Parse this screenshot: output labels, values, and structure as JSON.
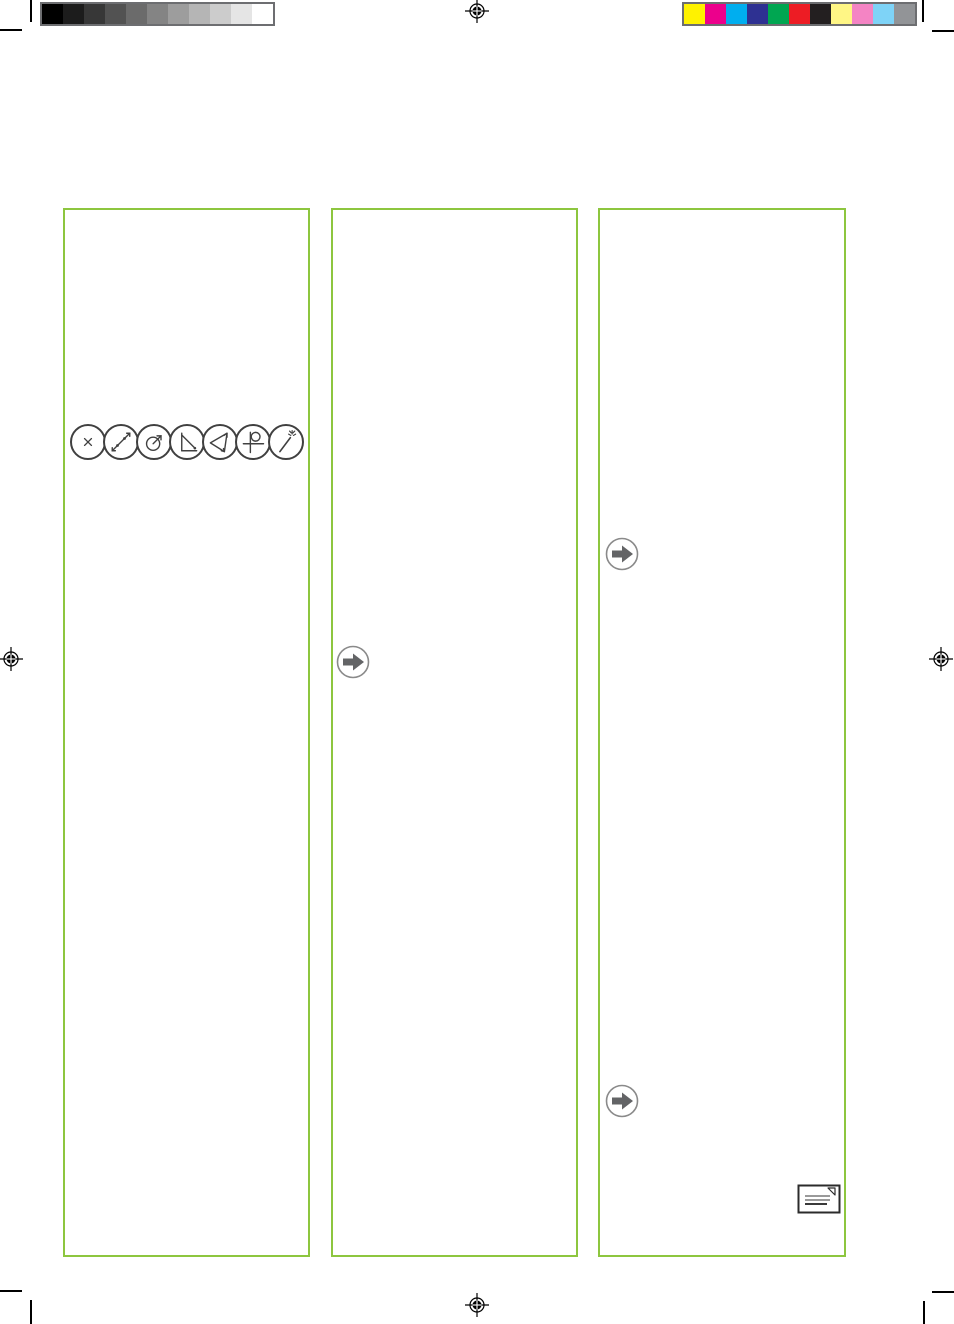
{
  "page": {
    "kind": "print-proof page, three empty text columns with printer marks",
    "background": "#FFFFFF",
    "accent_green": "#8DC63F",
    "mark_black": "#000000",
    "bar_border_gray": "#6D6E71"
  },
  "calibration": {
    "grayscale_bar": {
      "name": "grayscale-calibration-bar",
      "steps": [
        "#000000",
        "#1C1C1C",
        "#373737",
        "#525252",
        "#6B6B6B",
        "#848484",
        "#9D9D9D",
        "#B5B5B5",
        "#CCCCCC",
        "#E5E5E5",
        "#FFFFFF"
      ]
    },
    "color_bar": {
      "name": "cmyk-color-calibration-bar",
      "steps": [
        "#FFF200",
        "#EC008C",
        "#00AEEF",
        "#2E3192",
        "#00A651",
        "#ED1C24",
        "#231F20",
        "#FFF685",
        "#F484C4",
        "#7ED3F7",
        "#929497"
      ]
    }
  },
  "registration_marks": [
    {
      "position": "top-center"
    },
    {
      "position": "left-middle"
    },
    {
      "position": "right-middle"
    },
    {
      "position": "bottom-center"
    }
  ],
  "columns": [
    {
      "name": "column-1",
      "icons": [
        "point-cross-icon",
        "line-through-points-icon",
        "circle-arrow-icon",
        "right-angle-icon",
        "angle-triangle-icon",
        "perpendicular-loop-icon",
        "magic-wand-icon"
      ]
    },
    {
      "name": "column-2",
      "icons": [
        "arrow-right-icon"
      ]
    },
    {
      "name": "column-3",
      "icons": [
        "arrow-right-icon",
        "arrow-right-icon",
        "note-icon"
      ]
    }
  ],
  "icon_colors": {
    "tool_stroke": "#404040",
    "arrow_circle": "#8A8A8A",
    "arrow_fill": "#636466",
    "note_border": "#2B2B2B",
    "note_line_gray": "#9A9A9A",
    "note_line_dark": "#3A3A3A"
  }
}
